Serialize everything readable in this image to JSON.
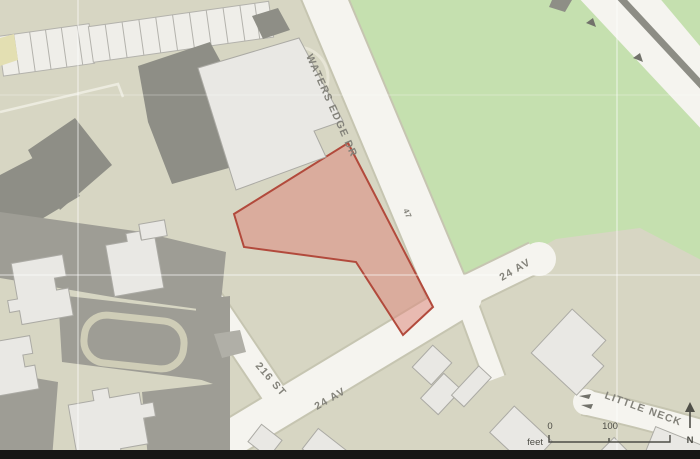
{
  "map": {
    "street_labels": {
      "waters_edge_dr": "WATERS EDGE DR",
      "parcel_number": "47",
      "av_24_upper": "24 AV",
      "av_24_lower": "24 AV",
      "st_216": "216 ST",
      "little_neck": "LITTLE NECK"
    },
    "north_arrow_label": "N",
    "scale_bar": {
      "unit_label": "feet",
      "tick_labels": [
        "0",
        "100"
      ]
    },
    "colors": {
      "highlight_parcel_fill": "#DC8B7E",
      "highlight_parcel_stroke": "#B24A3C",
      "park_green": "#C5E0AF",
      "road_white": "#F5F4EF",
      "block_tan": "#D7D6C3",
      "building_light": "#E9E8E4",
      "building_dark": "#8E8E86",
      "parking_gray": "#9E9D95",
      "label_gray": "#83827A",
      "scale_bar_color": "#4D4D46",
      "median_gray": "#8D8D85",
      "bottom_bar_black": "#161616",
      "gridline_white": "#FFFFFF"
    }
  }
}
